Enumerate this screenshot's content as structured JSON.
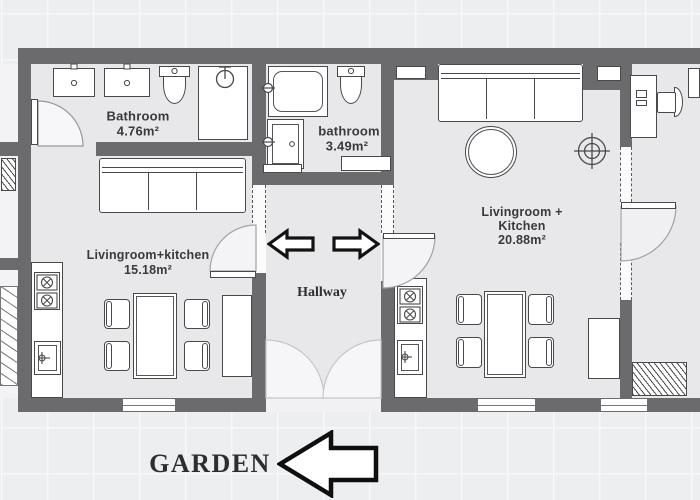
{
  "title": "Apartment floor plan with garden",
  "colors": {
    "wall": "#6b6b6d",
    "floor": "#e8e8ea",
    "background": "#edeef0",
    "outline": "#49494b",
    "text": "#3a3a3a"
  },
  "rooms": {
    "bathroom_left": {
      "label": "Bathroom",
      "area": "4.76m²"
    },
    "bathroom_middle": {
      "label": "bathroom",
      "area": "3.49m²"
    },
    "living_left": {
      "label": "Livingroom+kitchen",
      "area": "15.18m²"
    },
    "living_right": {
      "line1": "Livingroom +",
      "line2": "Kitchen",
      "area": "20.88m²"
    },
    "hallway": {
      "label": "Hallway"
    },
    "garden": {
      "label": "GARDEN"
    }
  },
  "icons": {
    "hallway_arrow_left": "direction to left apartment",
    "hallway_arrow_right": "direction to right apartment",
    "garden_arrow": "direction to garden"
  }
}
